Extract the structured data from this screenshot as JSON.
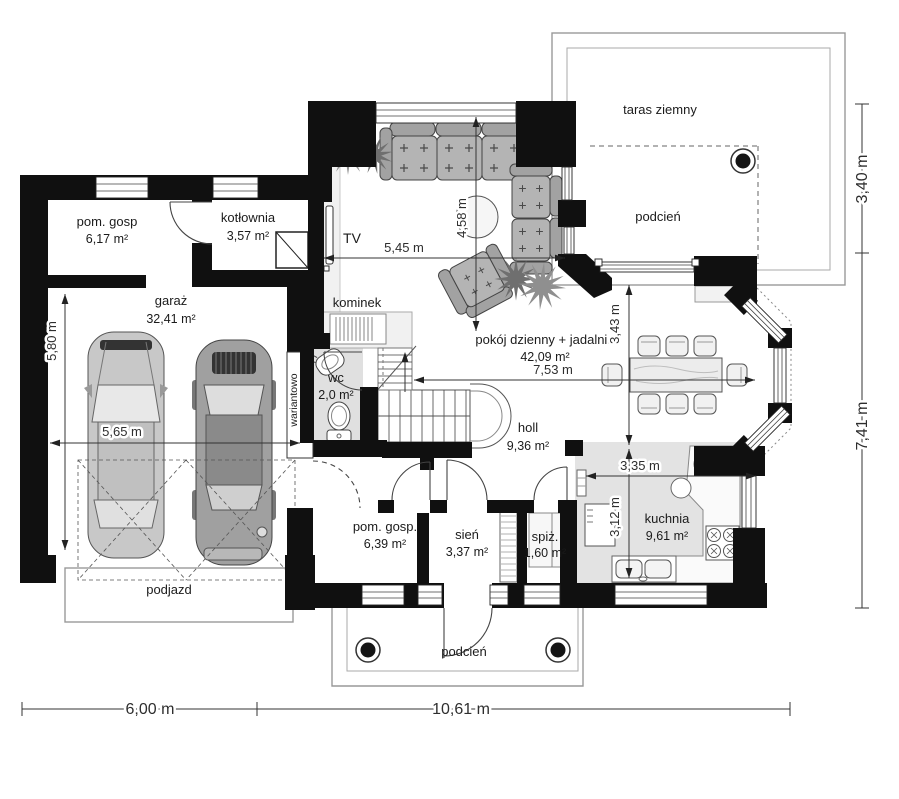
{
  "rooms": [
    {
      "name": "pom. gosp",
      "area": "6,17 m²"
    },
    {
      "name": "kotłownia",
      "area": "3,57 m²"
    },
    {
      "name": "garaż",
      "area": "32,41 m²"
    },
    {
      "name": "pokój dzienny + jadalnia",
      "area": "42,09 m²"
    },
    {
      "name": "wc",
      "area": "2,0 m²"
    },
    {
      "name": "holl",
      "area": "9,36 m²"
    },
    {
      "name": "pom. gosp.",
      "area": "6,39 m²"
    },
    {
      "name": "sień",
      "area": "3,37 m²"
    },
    {
      "name": "spiż.",
      "area": "1,60 m²"
    },
    {
      "name": "kuchnia",
      "area": "9,61 m²"
    }
  ],
  "outdoor": {
    "taras": "taras ziemny",
    "podcien_top": "podcień",
    "podcien_bottom": "podcień",
    "podjazd": "podjazd"
  },
  "features": {
    "tv": "TV",
    "fireplace": "kominek",
    "variant": "wariantowo"
  },
  "dimensions": {
    "living_width": "5,45 m",
    "living_depth": "4,58 m",
    "dining_depth": "3,43 m",
    "interior_width": "7,53 m",
    "kitchen_width": "3,35 m",
    "kitchen_depth": "3,12 m",
    "garage_depth": "5,80 m",
    "garage_width": "5,65 m",
    "total_left": "6,00 m",
    "total_right": "10,61 m",
    "side_top": "3,40 m",
    "side_bottom": "7,41 m"
  },
  "colors": {
    "wall": "#101010",
    "floor_accent": "#e2e2e2",
    "furniture": "#b4b4b4",
    "dimension_text": "#2e2e2e"
  }
}
